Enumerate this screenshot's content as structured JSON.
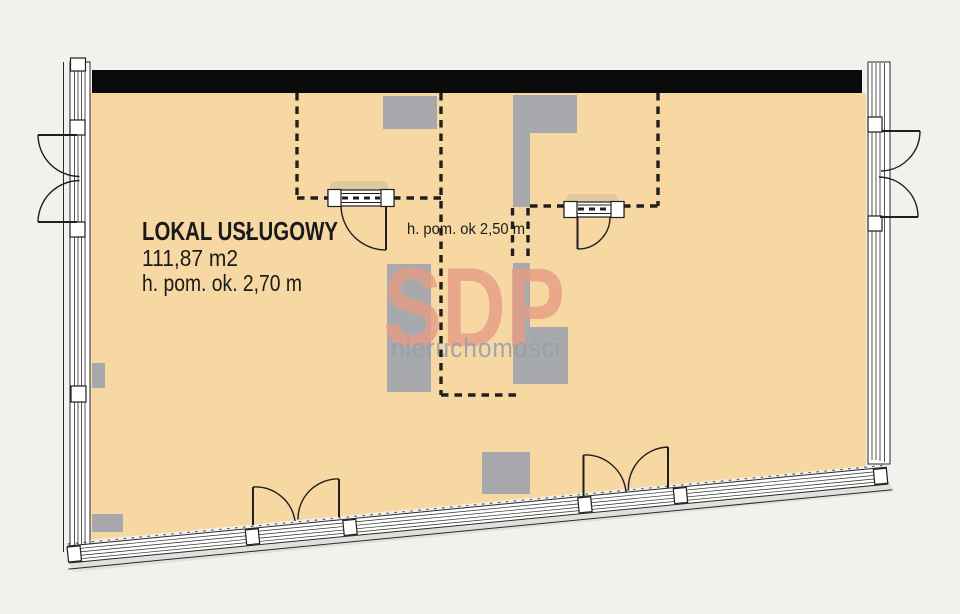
{
  "plan": {
    "type": "floor-plan",
    "labels": {
      "unit_name": "LOKAL USŁUGOWY",
      "area": "111,87 m2",
      "ceiling_height": "h. pom. ok. 2,70 m",
      "ceiling_height_secondary": "h. pom. ok 2,50 m"
    },
    "watermark": {
      "brand": "SDP",
      "subtitle": "nieruchomości"
    },
    "colors": {
      "background": "#f2f1ee",
      "floor": "#f7d8a3",
      "wall_black": "#0b0b0b",
      "column_gray": "#a7a9ac",
      "watermark_brand": "#e69e85",
      "watermark_subtitle": "#97a0ac",
      "line": "#1f1f1f"
    }
  }
}
